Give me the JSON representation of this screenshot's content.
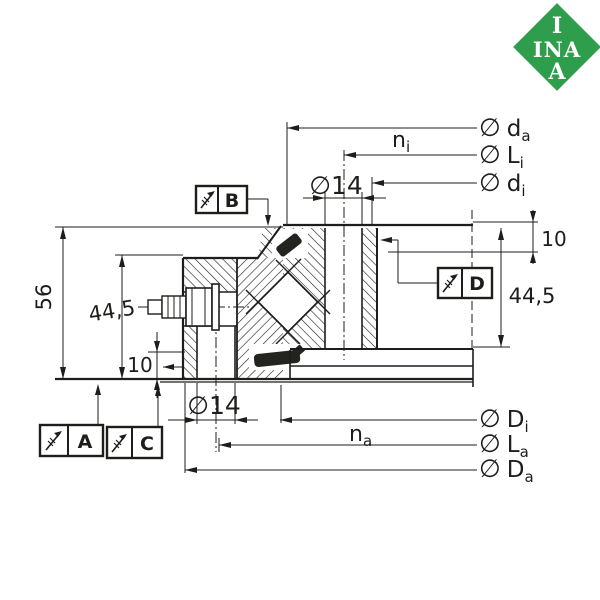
{
  "drawing": {
    "type": "bearing-cross-section",
    "line_color": "#1d1d1b",
    "background": "#ffffff",
    "seal_color": "#23231f"
  },
  "logo": {
    "color": "#2f9e4c",
    "row1": "I",
    "row2": "INA",
    "row3": "A"
  },
  "labels": {
    "top": [
      {
        "symbol": "∅",
        "main": "d",
        "sub": "a"
      },
      {
        "symbol": "∅",
        "main": "L",
        "sub": "i"
      },
      {
        "symbol": "∅",
        "main": "d",
        "sub": "i"
      }
    ],
    "bottom": [
      {
        "symbol": "∅",
        "main": "D",
        "sub": "i"
      },
      {
        "symbol": "∅",
        "main": "L",
        "sub": "a"
      },
      {
        "symbol": "∅",
        "main": "D",
        "sub": "a"
      }
    ]
  },
  "dimensions": {
    "bolt_hole_top": "∅14",
    "bolt_hole_bottom": "∅14",
    "total_height": "56",
    "ring_height_left": "44,5",
    "ring_height_right": "44,5",
    "step_left": "10",
    "step_right": "10",
    "n_i": {
      "main": "n",
      "sub": "i"
    },
    "n_a": {
      "main": "n",
      "sub": "a"
    }
  },
  "datums": {
    "a": "A",
    "b": "B",
    "c": "C",
    "d": "D"
  }
}
